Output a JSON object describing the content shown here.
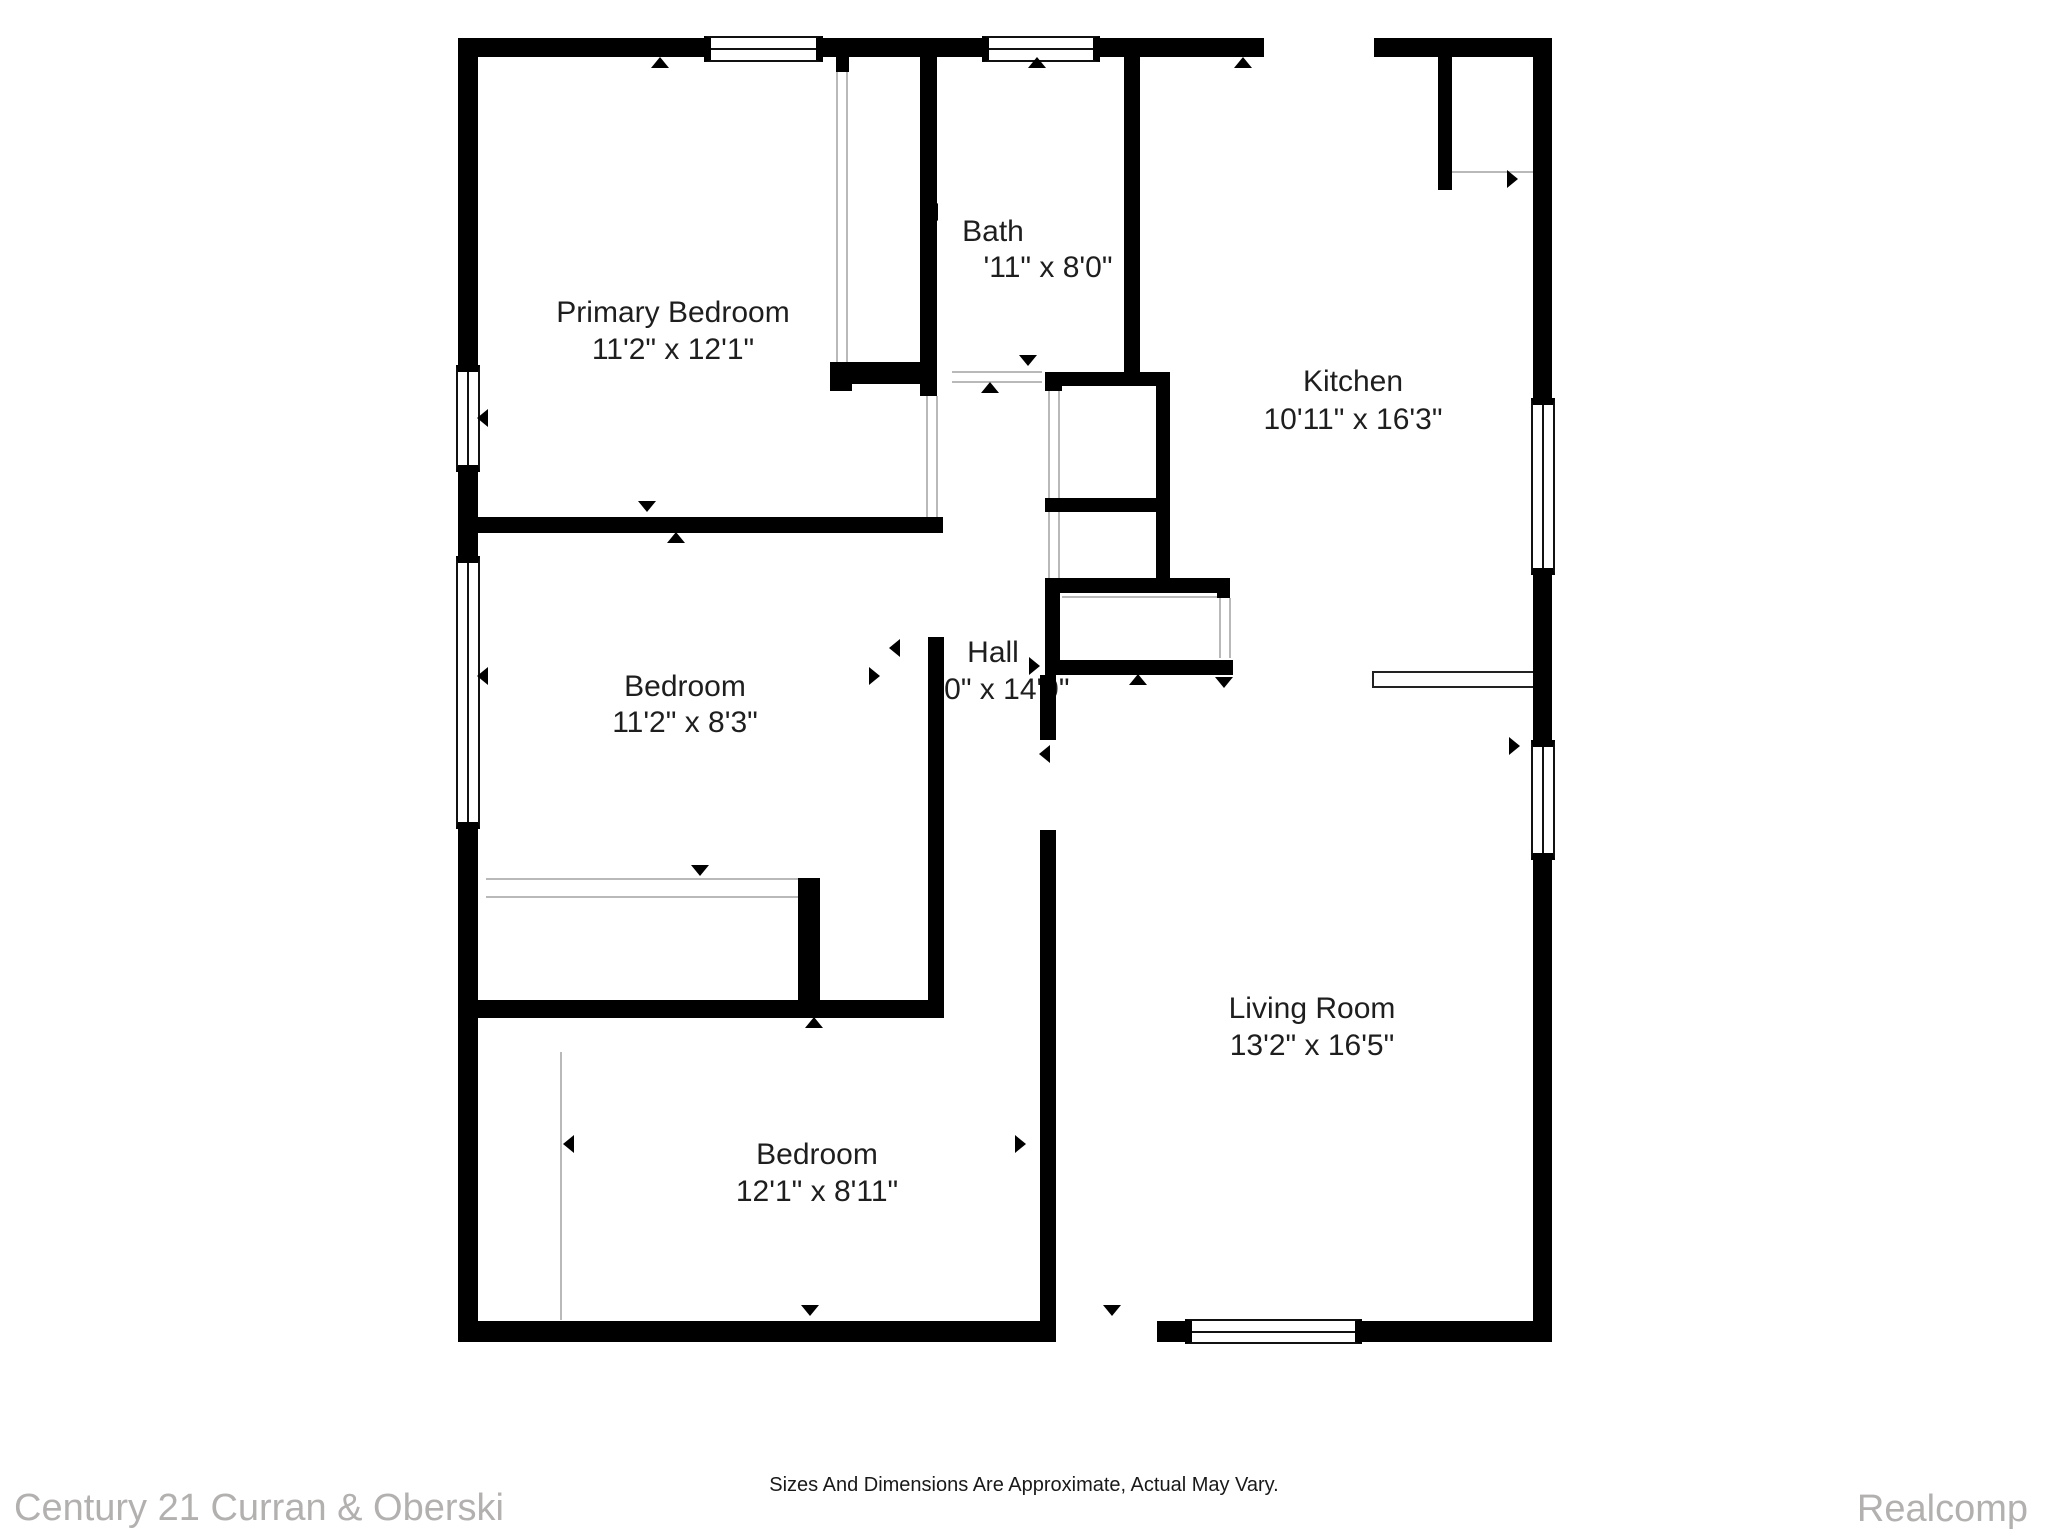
{
  "plan": {
    "rooms": [
      {
        "id": "primary-bedroom",
        "name": "Primary Bedroom",
        "dims": "11'2\" x 12'1\""
      },
      {
        "id": "bath",
        "name": "Bath",
        "dims": "'11\" x 8'0\""
      },
      {
        "id": "kitchen",
        "name": "Kitchen",
        "dims": "10'11\" x 16'3\""
      },
      {
        "id": "bedroom-middle",
        "name": "Bedroom",
        "dims": "11'2\" x 8'3\""
      },
      {
        "id": "hall",
        "name": "Hall",
        "dims": "'0\" x 14'9\""
      },
      {
        "id": "living-room",
        "name": "Living Room",
        "dims": "13'2\" x 16'5\""
      },
      {
        "id": "bedroom-lower",
        "name": "Bedroom",
        "dims": "12'1\" x 8'11\""
      }
    ],
    "icons": {
      "door_marker_icon": "small solid black triangle",
      "window_icon": "double-line glazing symbol"
    }
  },
  "footer": {
    "brokerage": "Century 21 Curran & Oberski",
    "disclaimer": "Sizes And Dimensions Are Approximate, Actual May Vary.",
    "provider": "Realcomp"
  },
  "colors": {
    "wall": "#000000",
    "room_text": "#1e1e1e",
    "footer_gray": "#b3b0b0",
    "thin_line": "#b9b9b9"
  }
}
